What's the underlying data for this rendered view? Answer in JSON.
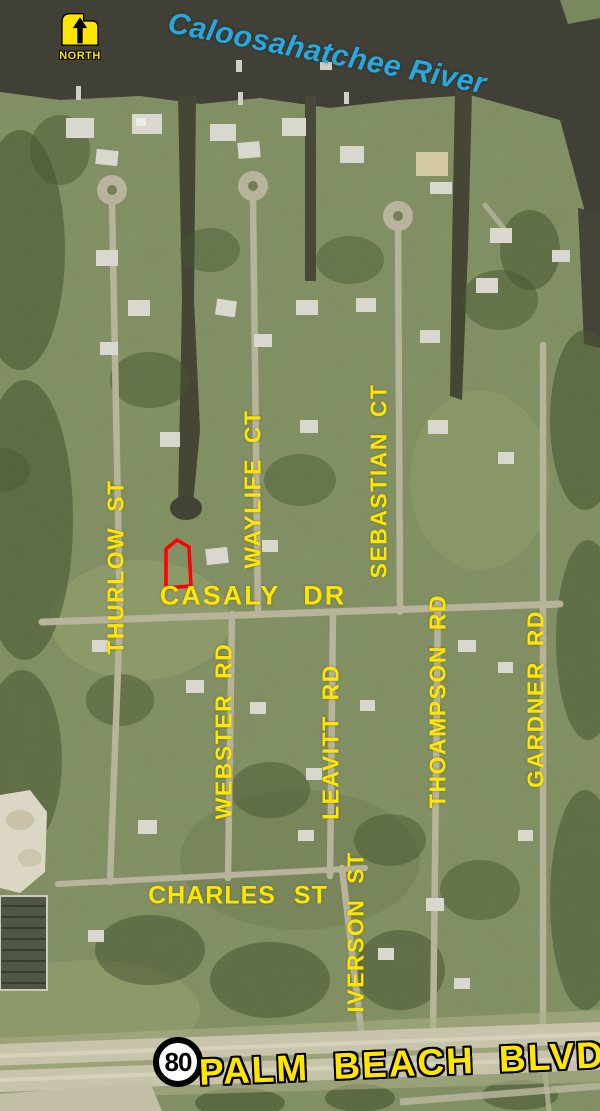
{
  "map": {
    "north_marker": {
      "label": "NORTH"
    },
    "river": {
      "label": "Caloosahatchee River"
    },
    "highway": {
      "route_number": "80",
      "label": "PALM BEACH BLVD"
    },
    "streets": {
      "thurlow": "THURLOW ST",
      "waylife": "WAYLIFE CT",
      "sebastian": "SEBASTIAN CT",
      "casaly": "CASALY DR",
      "webster": "WEBSTER RD",
      "leavitt": "LEAVITT RD",
      "thoampson": "THOAMPSON RD",
      "gardner": "GARDNER RD",
      "charles": "CHARLES ST",
      "iverson": "IVERSON ST"
    },
    "colors": {
      "street_label": "#FFE600",
      "river_label": "#29A8E0",
      "parcel_outline": "#FF0000",
      "water": "#3b3a31",
      "road": "#b7b39b"
    },
    "annotations": {
      "parcel_highlight": "red outlined parcel north of Casaly Dr"
    }
  }
}
